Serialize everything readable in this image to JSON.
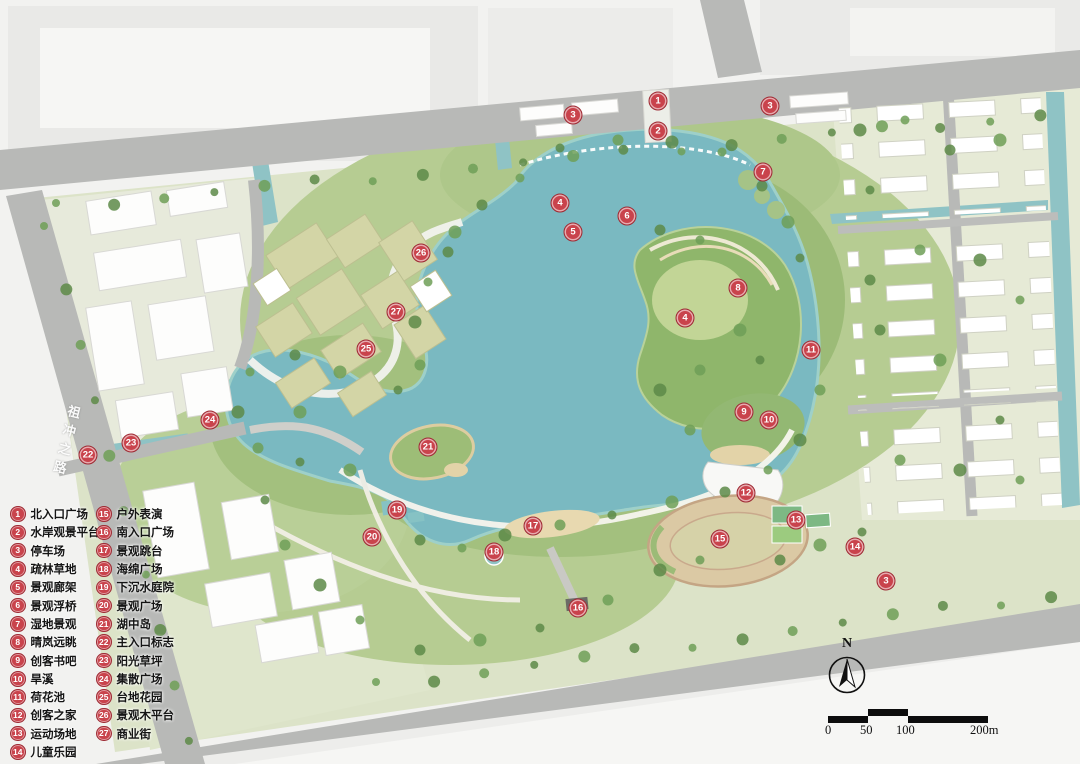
{
  "map": {
    "road_label": "祖冲之路",
    "north_label": "N"
  },
  "scale_bar": {
    "ticks": [
      "0",
      "50",
      "100",
      "200m"
    ]
  },
  "legend": {
    "columns": [
      {
        "items": [
          {
            "num": "1",
            "label": "北入口广场"
          },
          {
            "num": "2",
            "label": "水岸观景平台"
          },
          {
            "num": "3",
            "label": "停车场"
          },
          {
            "num": "4",
            "label": "疏林草地"
          },
          {
            "num": "5",
            "label": "景观廊架"
          },
          {
            "num": "6",
            "label": "景观浮桥"
          },
          {
            "num": "7",
            "label": "湿地景观"
          },
          {
            "num": "8",
            "label": "晴岚远眺"
          },
          {
            "num": "9",
            "label": "创客书吧"
          },
          {
            "num": "10",
            "label": "旱溪"
          },
          {
            "num": "11",
            "label": "荷花池"
          },
          {
            "num": "12",
            "label": "创客之家"
          },
          {
            "num": "13",
            "label": "运动场地"
          },
          {
            "num": "14",
            "label": "儿童乐园"
          }
        ]
      },
      {
        "items": [
          {
            "num": "15",
            "label": "户外表演"
          },
          {
            "num": "16",
            "label": "南入口广场"
          },
          {
            "num": "17",
            "label": "景观跳台"
          },
          {
            "num": "18",
            "label": "海绵广场"
          },
          {
            "num": "19",
            "label": "下沉水庭院"
          },
          {
            "num": "20",
            "label": "景观广场"
          },
          {
            "num": "21",
            "label": "湖中岛"
          },
          {
            "num": "22",
            "label": "主入口标志"
          },
          {
            "num": "23",
            "label": "阳光草坪"
          },
          {
            "num": "24",
            "label": "集散广场"
          },
          {
            "num": "25",
            "label": "台地花园"
          },
          {
            "num": "26",
            "label": "景观木平台"
          },
          {
            "num": "27",
            "label": "商业街"
          }
        ]
      }
    ]
  },
  "markers": [
    {
      "num": "1",
      "x": 658,
      "y": 101
    },
    {
      "num": "2",
      "x": 658,
      "y": 131
    },
    {
      "num": "3",
      "x": 573,
      "y": 115
    },
    {
      "num": "3",
      "x": 770,
      "y": 106
    },
    {
      "num": "3",
      "x": 886,
      "y": 581
    },
    {
      "num": "4",
      "x": 560,
      "y": 203
    },
    {
      "num": "4",
      "x": 685,
      "y": 318
    },
    {
      "num": "5",
      "x": 573,
      "y": 232
    },
    {
      "num": "6",
      "x": 627,
      "y": 216
    },
    {
      "num": "7",
      "x": 763,
      "y": 172
    },
    {
      "num": "8",
      "x": 738,
      "y": 288
    },
    {
      "num": "9",
      "x": 744,
      "y": 412
    },
    {
      "num": "10",
      "x": 769,
      "y": 420
    },
    {
      "num": "11",
      "x": 811,
      "y": 350
    },
    {
      "num": "12",
      "x": 746,
      "y": 493
    },
    {
      "num": "13",
      "x": 796,
      "y": 520
    },
    {
      "num": "14",
      "x": 855,
      "y": 547
    },
    {
      "num": "15",
      "x": 720,
      "y": 539
    },
    {
      "num": "16",
      "x": 578,
      "y": 608
    },
    {
      "num": "17",
      "x": 533,
      "y": 526
    },
    {
      "num": "18",
      "x": 494,
      "y": 552
    },
    {
      "num": "19",
      "x": 397,
      "y": 510
    },
    {
      "num": "20",
      "x": 372,
      "y": 537
    },
    {
      "num": "21",
      "x": 428,
      "y": 447
    },
    {
      "num": "22",
      "x": 88,
      "y": 455
    },
    {
      "num": "23",
      "x": 131,
      "y": 443
    },
    {
      "num": "24",
      "x": 210,
      "y": 420
    },
    {
      "num": "25",
      "x": 366,
      "y": 349
    },
    {
      "num": "26",
      "x": 421,
      "y": 253
    },
    {
      "num": "27",
      "x": 396,
      "y": 312
    }
  ],
  "colors": {
    "marker_red": "#c9434c",
    "lake_teal": "#7ab9c1",
    "canal_teal": "#8fc3c5",
    "park_green": "#b6cc92",
    "road_gray": "#b8b9b7"
  }
}
